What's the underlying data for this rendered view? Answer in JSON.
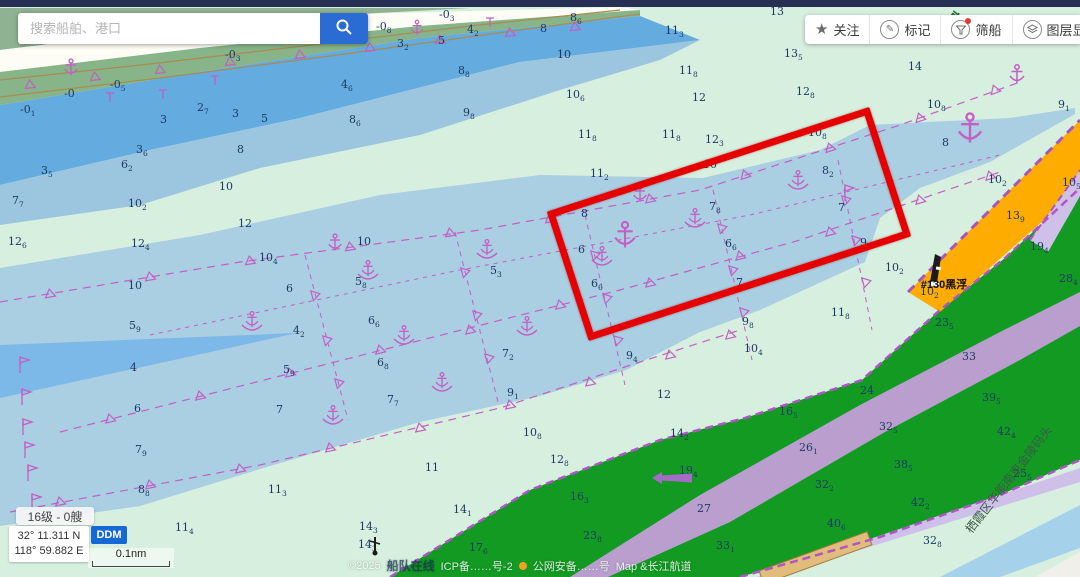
{
  "search": {
    "placeholder": "搜索船舶、港口"
  },
  "toolbar": {
    "items": [
      {
        "label": "关注"
      },
      {
        "label": "标记"
      },
      {
        "label": "筛船"
      },
      {
        "label": "图层显示"
      },
      {
        "label": ""
      }
    ]
  },
  "status": {
    "zoom_badge": "16级 - 0艘",
    "lat": "32° 11.311 N",
    "lon": "118° 59.882 E",
    "coord_mode": "DDM",
    "scale": "0.1nm",
    "copyright_prefix": "©2025",
    "brand": "船队在线",
    "icp": "ICP备……号-2",
    "psb": "公网安备……号",
    "map_credit": "Map &长江航道"
  },
  "map": {
    "colors": {
      "shallow_pale_green": "#d7efdf",
      "water_mid_blue": "#a9cee2",
      "water_deep_blue": "#64abdf",
      "water_bright_blue": "#7cb9e8",
      "land_green": "#129a23",
      "fairway_purple": "#c49fd8",
      "lavender": "#cfc0ea",
      "orange_shoal": "#ffac00",
      "symbol_magenta": "#c45fc4",
      "sounding_navy": "#1b3a63",
      "highlight_red": "#e60000"
    },
    "labels": [
      {
        "t": "南京港",
        "x": 962,
        "y": 30,
        "r": 40,
        "c": "#1e6b2f",
        "s": 13,
        "b": true
      },
      {
        "t": "#130黑浮",
        "x": 944,
        "y": 288,
        "r": 0,
        "c": "#111111",
        "s": 11,
        "b": true
      },
      {
        "t": "栖霞区华能南京金陵码头",
        "x": 1012,
        "y": 482,
        "r": -52,
        "c": "#3c5a48",
        "s": 12,
        "b": false
      }
    ],
    "soundings": [
      [
        20,
        113,
        "-0",
        "1"
      ],
      [
        64,
        97,
        "-0",
        ""
      ],
      [
        110,
        88,
        "-0",
        "5"
      ],
      [
        225,
        58,
        "-0",
        "3"
      ],
      [
        376,
        30,
        "-0",
        "8"
      ],
      [
        439,
        18,
        "-0",
        "3"
      ],
      [
        160,
        123,
        "3",
        ""
      ],
      [
        197,
        111,
        "2",
        "7"
      ],
      [
        232,
        117,
        "3",
        ""
      ],
      [
        261,
        122,
        "5",
        ""
      ],
      [
        341,
        88,
        "4",
        "6"
      ],
      [
        349,
        123,
        "8",
        "6"
      ],
      [
        397,
        47,
        "3",
        "2"
      ],
      [
        438,
        44,
        "5",
        ""
      ],
      [
        467,
        33,
        "4",
        "2"
      ],
      [
        540,
        32,
        "8",
        ""
      ],
      [
        570,
        21,
        "8",
        "6"
      ],
      [
        458,
        74,
        "8",
        "8"
      ],
      [
        463,
        116,
        "9",
        "8"
      ],
      [
        557,
        58,
        "10",
        ""
      ],
      [
        237,
        153,
        "8",
        ""
      ],
      [
        136,
        153,
        "3",
        "6"
      ],
      [
        121,
        168,
        "6",
        "2"
      ],
      [
        41,
        174,
        "3",
        "5"
      ],
      [
        219,
        190,
        "10",
        ""
      ],
      [
        12,
        204,
        "7",
        "7"
      ],
      [
        128,
        207,
        "10",
        "2"
      ],
      [
        238,
        227,
        "12",
        ""
      ],
      [
        8,
        245,
        "12",
        "6"
      ],
      [
        131,
        247,
        "12",
        "4"
      ],
      [
        566,
        98,
        "10",
        "6"
      ],
      [
        578,
        138,
        "11",
        "8"
      ],
      [
        590,
        177,
        "11",
        "2"
      ],
      [
        662,
        138,
        "11",
        "8"
      ],
      [
        705,
        143,
        "12",
        "3"
      ],
      [
        703,
        168,
        "10",
        ""
      ],
      [
        665,
        34,
        "11",
        "3"
      ],
      [
        679,
        74,
        "11",
        "8"
      ],
      [
        692,
        101,
        "12",
        ""
      ],
      [
        770,
        15,
        "13",
        ""
      ],
      [
        784,
        57,
        "13",
        "5"
      ],
      [
        796,
        95,
        "12",
        "8"
      ],
      [
        908,
        70,
        "14",
        ""
      ],
      [
        927,
        108,
        "10",
        "8"
      ],
      [
        1058,
        108,
        "9",
        "1"
      ],
      [
        942,
        146,
        "8",
        ""
      ],
      [
        988,
        183,
        "10",
        "2"
      ],
      [
        1062,
        186,
        "10",
        "5"
      ],
      [
        259,
        261,
        "10",
        "4"
      ],
      [
        357,
        245,
        "10",
        ""
      ],
      [
        286,
        292,
        "6",
        ""
      ],
      [
        355,
        285,
        "5",
        "8"
      ],
      [
        490,
        274,
        "5",
        "3"
      ],
      [
        293,
        334,
        "4",
        "2"
      ],
      [
        128,
        289,
        "10",
        ""
      ],
      [
        129,
        329,
        "5",
        "9"
      ],
      [
        130,
        371,
        "4",
        ""
      ],
      [
        134,
        412,
        "6",
        ""
      ],
      [
        276,
        413,
        "7",
        ""
      ],
      [
        283,
        373,
        "5",
        "9"
      ],
      [
        368,
        324,
        "6",
        "6"
      ],
      [
        377,
        366,
        "6",
        "8"
      ],
      [
        502,
        357,
        "7",
        "2"
      ],
      [
        507,
        396,
        "9",
        "1"
      ],
      [
        387,
        403,
        "7",
        "7"
      ],
      [
        523,
        436,
        "10",
        "8"
      ],
      [
        581,
        217,
        "8",
        ""
      ],
      [
        709,
        210,
        "7",
        "8"
      ],
      [
        838,
        211,
        "7",
        ""
      ],
      [
        822,
        174,
        "8",
        "2"
      ],
      [
        808,
        136,
        "10",
        "8"
      ],
      [
        578,
        253,
        "6",
        ""
      ],
      [
        725,
        247,
        "6",
        "6"
      ],
      [
        591,
        287,
        "6",
        "6"
      ],
      [
        736,
        286,
        "7",
        "7"
      ],
      [
        860,
        246,
        "9",
        "2"
      ],
      [
        885,
        271,
        "10",
        "2"
      ],
      [
        626,
        359,
        "9",
        "4"
      ],
      [
        742,
        325,
        "9",
        "8"
      ],
      [
        831,
        316,
        "11",
        "8"
      ],
      [
        744,
        352,
        "10",
        "4"
      ],
      [
        135,
        453,
        "7",
        "9"
      ],
      [
        138,
        493,
        "8",
        "8"
      ],
      [
        268,
        493,
        "11",
        "3"
      ],
      [
        175,
        531,
        "11",
        "4"
      ],
      [
        425,
        471,
        "11",
        ""
      ],
      [
        453,
        513,
        "14",
        "1"
      ],
      [
        359,
        530,
        "14",
        "3"
      ],
      [
        358,
        548,
        "14",
        "3"
      ],
      [
        469,
        551,
        "17",
        "6"
      ],
      [
        550,
        463,
        "12",
        "8"
      ],
      [
        657,
        398,
        "12",
        ""
      ],
      [
        570,
        500,
        "16",
        "3"
      ],
      [
        583,
        539,
        "23",
        "8"
      ],
      [
        679,
        474,
        "19",
        "4"
      ],
      [
        670,
        437,
        "14",
        "2"
      ],
      [
        697,
        512,
        "27",
        ""
      ],
      [
        935,
        326,
        "23",
        "5"
      ],
      [
        962,
        360,
        "33",
        ""
      ],
      [
        982,
        401,
        "39",
        "5"
      ],
      [
        997,
        435,
        "42",
        "4"
      ],
      [
        860,
        394,
        "24",
        ""
      ],
      [
        779,
        415,
        "16",
        "5"
      ],
      [
        799,
        451,
        "26",
        "1"
      ],
      [
        879,
        430,
        "32",
        "5"
      ],
      [
        894,
        468,
        "38",
        "5"
      ],
      [
        815,
        488,
        "32",
        "2"
      ],
      [
        911,
        506,
        "42",
        "2"
      ],
      [
        827,
        527,
        "40",
        "6"
      ],
      [
        716,
        549,
        "33",
        "1"
      ],
      [
        923,
        544,
        "32",
        "8"
      ],
      [
        1013,
        477,
        "25",
        "5"
      ],
      [
        1030,
        250,
        "19",
        "4"
      ],
      [
        1059,
        282,
        "28",
        "4"
      ],
      [
        920,
        295,
        "10",
        "2"
      ],
      [
        1006,
        219,
        "13",
        "9"
      ]
    ],
    "berths": [
      [
        252,
        322
      ],
      [
        368,
        271
      ],
      [
        404,
        336
      ],
      [
        442,
        383
      ],
      [
        487,
        250
      ],
      [
        527,
        327
      ],
      [
        602,
        257
      ],
      [
        695,
        219
      ],
      [
        798,
        181
      ],
      [
        333,
        416
      ]
    ],
    "anchors": [
      [
        625,
        239,
        1.4
      ],
      [
        970,
        133,
        1.6
      ],
      [
        71,
        70,
        0.9
      ],
      [
        335,
        245,
        0.9
      ],
      [
        640,
        196,
        0.9
      ],
      [
        1017,
        77,
        1.0
      ],
      [
        417,
        30,
        0.8
      ]
    ],
    "flags": [
      [
        20,
        365
      ],
      [
        22,
        397
      ],
      [
        23,
        427
      ],
      [
        25,
        450
      ],
      [
        28,
        473
      ],
      [
        32,
        502
      ],
      [
        845,
        193
      ]
    ],
    "tmarks": [
      [
        110,
        97
      ],
      [
        163,
        94
      ],
      [
        215,
        80
      ],
      [
        490,
        22
      ]
    ],
    "triangles": [
      [
        50,
        294,
        -10
      ],
      [
        150,
        277,
        -10
      ],
      [
        250,
        261,
        -9
      ],
      [
        350,
        247,
        -9
      ],
      [
        450,
        233,
        -9
      ],
      [
        550,
        219,
        -10
      ],
      [
        650,
        199,
        -12
      ],
      [
        745,
        175,
        -18
      ],
      [
        830,
        148,
        -18
      ],
      [
        920,
        118,
        -18
      ],
      [
        995,
        90,
        -20
      ],
      [
        30,
        85,
        -6
      ],
      [
        95,
        77,
        -6
      ],
      [
        160,
        70,
        -6
      ],
      [
        230,
        62,
        -6
      ],
      [
        300,
        55,
        -6
      ],
      [
        370,
        48,
        -6
      ],
      [
        440,
        40,
        -6
      ],
      [
        510,
        33,
        -6
      ],
      [
        575,
        27,
        -6
      ],
      [
        110,
        419,
        -13
      ],
      [
        200,
        396,
        -13
      ],
      [
        290,
        373,
        -13
      ],
      [
        380,
        350,
        -13
      ],
      [
        470,
        330,
        -13
      ],
      [
        560,
        305,
        -13
      ],
      [
        650,
        283,
        -13
      ],
      [
        740,
        256,
        -14
      ],
      [
        830,
        232,
        -14
      ],
      [
        920,
        200,
        -16
      ],
      [
        990,
        176,
        -16
      ],
      [
        60,
        502,
        -12
      ],
      [
        150,
        485,
        -12
      ],
      [
        240,
        469,
        -12
      ],
      [
        330,
        448,
        -12
      ],
      [
        420,
        428,
        -12
      ],
      [
        510,
        405,
        -12
      ],
      [
        590,
        382,
        -13
      ],
      [
        670,
        355,
        -13
      ],
      [
        730,
        335,
        -13
      ],
      [
        315,
        295,
        75
      ],
      [
        327,
        340,
        75
      ],
      [
        339,
        383,
        75
      ],
      [
        465,
        272,
        75
      ],
      [
        477,
        315,
        75
      ],
      [
        489,
        358,
        75
      ],
      [
        595,
        255,
        75
      ],
      [
        607,
        298,
        75
      ],
      [
        618,
        340,
        75
      ],
      [
        722,
        228,
        75
      ],
      [
        733,
        270,
        75
      ],
      [
        744,
        312,
        75
      ],
      [
        846,
        200,
        75
      ],
      [
        856,
        240,
        75
      ],
      [
        866,
        282,
        75
      ]
    ],
    "lines": [
      {
        "p": [
          [
            0,
            302
          ],
          [
            240,
            262
          ],
          [
            480,
            230
          ],
          [
            700,
            190
          ],
          [
            900,
            125
          ],
          [
            1020,
            82
          ]
        ],
        "c": "#c45fc4",
        "w": 1.2,
        "d": "8 6"
      },
      {
        "p": [
          [
            60,
            432
          ],
          [
            390,
            348
          ],
          [
            620,
            290
          ],
          [
            800,
            240
          ],
          [
            1000,
            172
          ]
        ],
        "c": "#c45fc4",
        "w": 1.2,
        "d": "8 6"
      },
      {
        "p": [
          [
            10,
            512
          ],
          [
            260,
            465
          ],
          [
            500,
            408
          ],
          [
            640,
            362
          ],
          [
            740,
            330
          ]
        ],
        "c": "#c45fc4",
        "w": 1.2,
        "d": "8 6"
      },
      {
        "p": [
          [
            150,
            335
          ],
          [
            450,
            272
          ],
          [
            750,
            215
          ],
          [
            1000,
            155
          ]
        ],
        "c": "#c45fc4",
        "w": 1,
        "d": "4 5"
      },
      {
        "p": [
          [
            305,
            255
          ],
          [
            348,
            420
          ]
        ],
        "c": "#c45fc4",
        "w": 1,
        "d": "5 5"
      },
      {
        "p": [
          [
            455,
            232
          ],
          [
            498,
            402
          ]
        ],
        "c": "#c45fc4",
        "w": 1,
        "d": "5 5"
      },
      {
        "p": [
          [
            585,
            215
          ],
          [
            625,
            385
          ]
        ],
        "c": "#c45fc4",
        "w": 1,
        "d": "5 5"
      },
      {
        "p": [
          [
            713,
            190
          ],
          [
            752,
            360
          ]
        ],
        "c": "#c45fc4",
        "w": 1,
        "d": "5 5"
      },
      {
        "p": [
          [
            838,
            160
          ],
          [
            872,
            330
          ]
        ],
        "c": "#c45fc4",
        "w": 1,
        "d": "5 5"
      },
      {
        "p": [
          [
            390,
            577
          ],
          [
            530,
            490
          ],
          [
            660,
            440
          ],
          [
            745,
            418
          ],
          [
            862,
            380
          ],
          [
            940,
            310
          ],
          [
            1005,
            258
          ],
          [
            1080,
            188
          ]
        ],
        "c": "#b055c5",
        "w": 2.5,
        "d": "8 5"
      },
      {
        "p": [
          [
            740,
            577
          ],
          [
            880,
            537
          ],
          [
            1000,
            495
          ],
          [
            1080,
            460
          ]
        ],
        "c": "#b055c5",
        "w": 2.5,
        "d": "8 5"
      },
      {
        "p": [
          [
            908,
            292
          ],
          [
            1080,
            120
          ]
        ],
        "c": "#a855c0",
        "w": 3,
        "d": "9 6"
      },
      {
        "p": [
          [
            1030,
            240
          ],
          [
            1080,
            170
          ]
        ],
        "c": "#b055c5",
        "w": 2,
        "d": "7 5"
      },
      {
        "p": [
          [
            0,
            80
          ],
          [
            150,
            64
          ],
          [
            320,
            44
          ],
          [
            470,
            26
          ],
          [
            620,
            10
          ]
        ],
        "c": "#a98b4f",
        "w": 1.2,
        "d": ""
      },
      {
        "p": [
          [
            0,
            97
          ],
          [
            160,
            78
          ],
          [
            330,
            56
          ],
          [
            520,
            30
          ],
          [
            640,
            14
          ]
        ],
        "c": "#a98b4f",
        "w": 1.2,
        "d": ""
      }
    ],
    "arrow": {
      "x": 652,
      "y": 478
    },
    "buoys": [
      {
        "x": 933,
        "y": 280,
        "kind": "tall"
      },
      {
        "x": 375,
        "y": 552,
        "kind": "small"
      }
    ],
    "redbox": {
      "cx": 729,
      "cy": 224,
      "w": 325,
      "h": 122,
      "rot": -18
    }
  }
}
